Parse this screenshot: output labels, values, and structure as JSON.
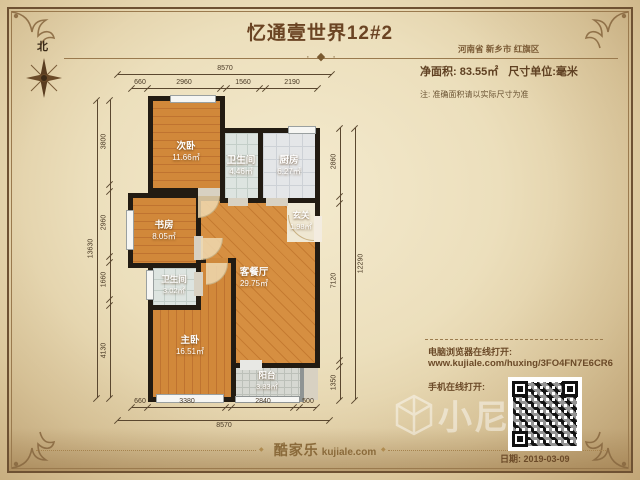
{
  "page": {
    "title": "忆通壹世界12#2",
    "location": "河南省 新乡市 红旗区",
    "net_area_label": "净面积: 83.55㎡",
    "unit_label": "尺寸单位:毫米",
    "note": "注: 准确面积请以实际尺寸为准",
    "compass_label": "北",
    "date": "日期: 2019-03-09",
    "logo_cn": "酷家乐",
    "logo_en": "kujiale.com",
    "watermark": "小尼",
    "ornament_glyph": "· ◆ ·",
    "diamond_glyph": "◆"
  },
  "links": {
    "pc_label": "电脑浏览器在线打开:",
    "pc_url": "www.kujiale.com/huxing/3FO4FN7E6CR6",
    "mobile_label": "手机在线打开:"
  },
  "plan": {
    "rooms": [
      {
        "name": "次卧",
        "area": "11.66㎡"
      },
      {
        "name": "卫生间",
        "area": "4.46㎡"
      },
      {
        "name": "厨房",
        "area": "6.27㎡"
      },
      {
        "name": "书房",
        "area": "8.05㎡"
      },
      {
        "name": "玄关",
        "area": "1.98㎡"
      },
      {
        "name": "客餐厅",
        "area": "29.75㎡"
      },
      {
        "name": "卫生间",
        "area": "3.02㎡"
      },
      {
        "name": "主卧",
        "area": "16.51㎡"
      },
      {
        "name": "阳台",
        "area": "3.83㎡"
      }
    ]
  },
  "dims": {
    "top": {
      "total": "8570",
      "segments": [
        "660",
        "2960",
        "1560",
        "2190"
      ]
    },
    "bottom": {
      "total": "8570",
      "segments": [
        "660",
        "3380",
        "2840",
        "500"
      ]
    },
    "left": {
      "total": "13630",
      "segments": [
        "3800",
        "2960",
        "1660",
        "4130"
      ]
    },
    "right": {
      "total": "12290",
      "segments": [
        "2860",
        "7120",
        "1350"
      ]
    }
  },
  "colors": {
    "parchment": "#ecdfbc",
    "frame_brown": "#6e5132",
    "title_brown": "#6b4423",
    "wood_floor": "#d1883a",
    "tile_floor": "#dde4e0",
    "wall_black": "#221b12",
    "balcony_wall": "#8f9494",
    "dim_line": "#5a472f"
  }
}
